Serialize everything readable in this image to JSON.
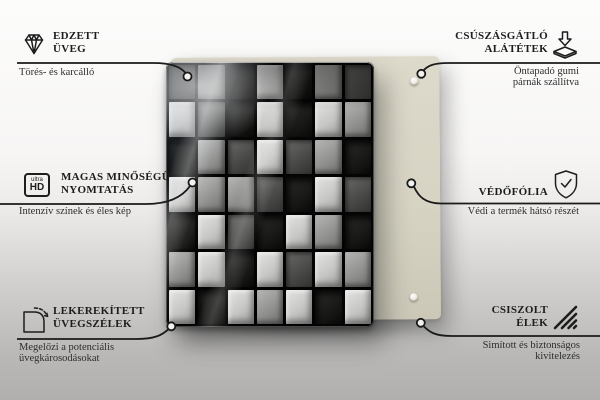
{
  "product": {
    "description": "glass board with 3D concrete cubes print and beige back panel",
    "back_panel_color": "#d9d6c7",
    "cube_levels": [
      [
        1,
        2,
        0,
        3,
        0,
        2,
        1
      ],
      [
        3,
        1,
        0,
        3,
        0,
        3,
        2
      ],
      [
        0,
        2,
        1,
        3,
        1,
        2,
        0
      ],
      [
        3,
        2,
        2,
        1,
        0,
        3,
        1
      ],
      [
        0,
        3,
        1,
        0,
        3,
        2,
        0
      ],
      [
        2,
        3,
        0,
        3,
        1,
        3,
        2
      ],
      [
        3,
        0,
        3,
        2,
        3,
        0,
        3
      ]
    ]
  },
  "colors": {
    "line": "#1a1a1a",
    "title_text": "#1d1d1d",
    "subtitle_text": "#2e2e2e",
    "background_top": "#fcfcfb",
    "background_bottom": "#b0afae"
  },
  "callouts": {
    "top_left": {
      "icon": "diamond-icon",
      "title_lines": [
        "EDZETT",
        "ÜVEG"
      ],
      "subtitle_lines": [
        "Törés- és karcálló"
      ]
    },
    "top_right": {
      "icon": "anti-slip-pads-icon",
      "title_lines": [
        "CSÚSZÁSGÁTLÓ",
        "ALÁTÉTEK"
      ],
      "subtitle_lines": [
        "Öntapadó gumi",
        "párnák szállítva"
      ]
    },
    "middle_left": {
      "icon": "ultra-hd-icon",
      "icon_text": {
        "small": "ultra",
        "big": "HD"
      },
      "title_lines": [
        "MAGAS MINŐSÉGŰ",
        "NYOMTATÁS"
      ],
      "subtitle_lines": [
        "Intenzív színek és éles kép"
      ]
    },
    "middle_right": {
      "icon": "shield-check-icon",
      "title_lines": [
        "VÉDŐFÓLIA"
      ],
      "subtitle_lines": [
        "Védi a termék hátsó részét"
      ]
    },
    "bottom_left": {
      "icon": "rounded-corner-icon",
      "title_lines": [
        "LEKEREKÍTETT",
        "ÜVEGSZÉLEK"
      ],
      "subtitle_lines": [
        "Megelőzi a potenciális",
        "üvegkárosodásokat"
      ]
    },
    "bottom_right": {
      "icon": "polished-edges-icon",
      "title_lines": [
        "CSISZOLT",
        "ÉLEK"
      ],
      "subtitle_lines": [
        "Simított és biztonságos",
        "kivitelezés"
      ]
    }
  }
}
